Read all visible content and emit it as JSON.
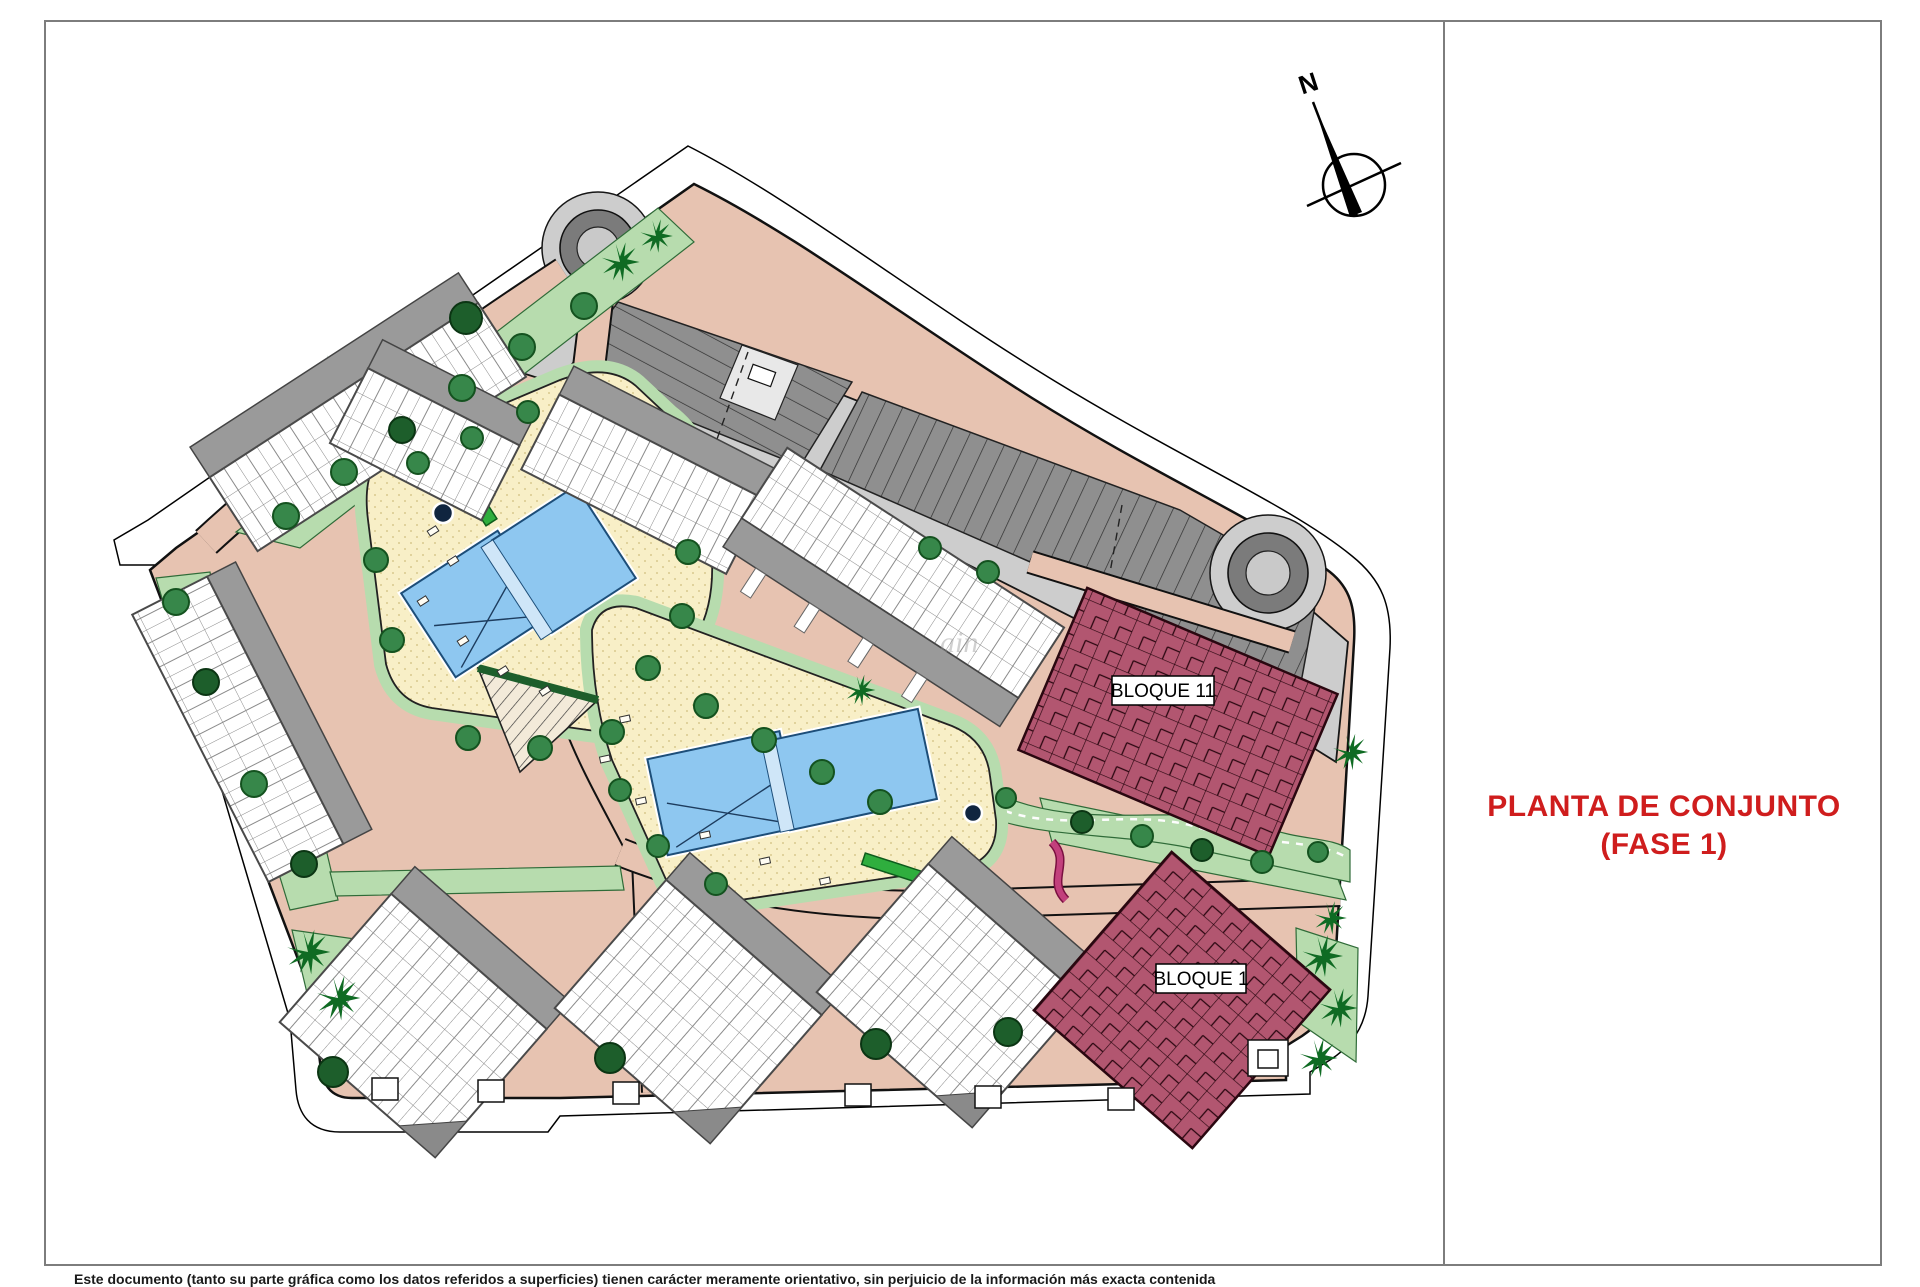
{
  "sheet": {
    "title_line1": "PLANTA DE CONJUNTO",
    "title_line2": "(FASE 1)",
    "disclaimer": "Este documento (tanto su parte gráfica como los datos referidos a superficies) tienen carácter meramente orientativo, sin perjuicio de la información más exacta contenida",
    "watermark": "ain"
  },
  "compass": {
    "label": "N"
  },
  "plan": {
    "block_labels": {
      "bloque11": "BLOQUE 11",
      "bloque1": "BLOQUE 1"
    },
    "colors": {
      "road_salmon": "#e7c3b1",
      "road_gray": "#cdcdcd",
      "parking_gray": "#8f8f8f",
      "ring_gray": "#7b7b7b",
      "island_gray": "#c9c9c9",
      "green_light": "#b7dcae",
      "green_tree": "#37874a",
      "green_dark": "#1d5e2b",
      "deck_cream": "#f8efc7",
      "pool_blue": "#8ec7f0",
      "pool_edge": "#1d4e79",
      "block_maroon": "#b25670",
      "block_line": "#2a0710",
      "garage_gray": "#9a9a9a",
      "title_red": "#cf1d1d"
    }
  }
}
